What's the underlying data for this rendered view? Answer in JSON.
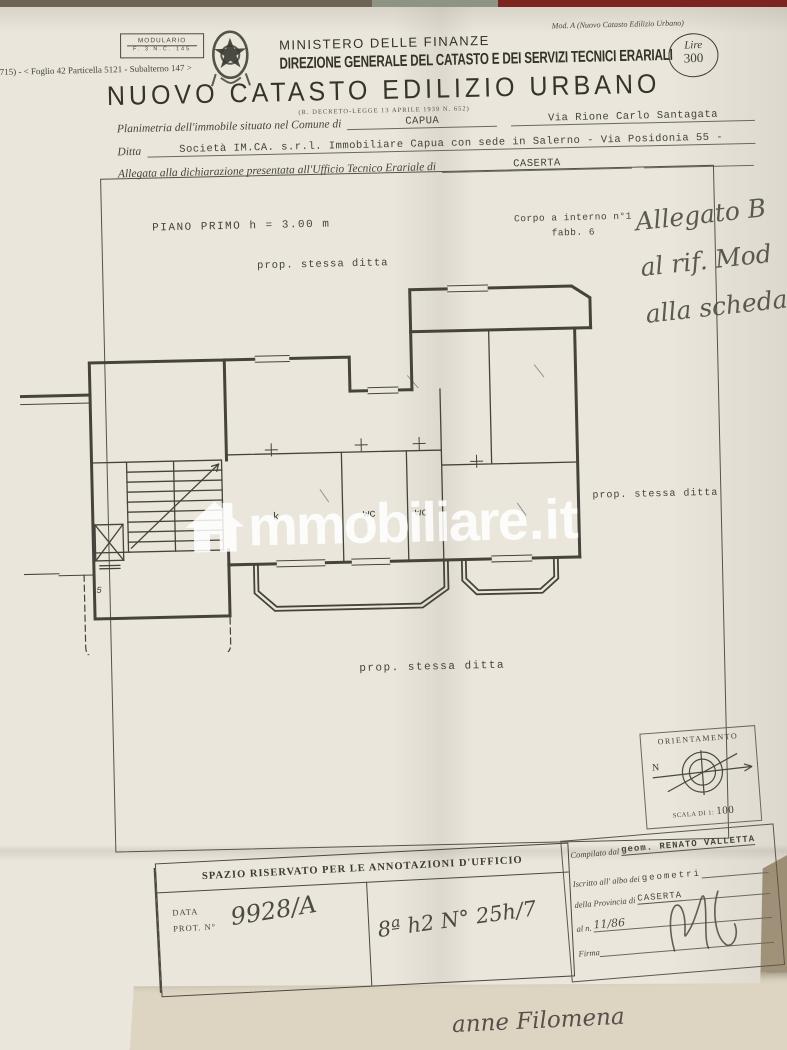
{
  "stamp": {
    "line1": "MODULARIO",
    "line2": "F. 3  N.C.  145"
  },
  "top_right_note": "Mod. A (Nuovo Catasto Edilizio Urbano)",
  "ref_line": "(B715) - < Foglio 42 Particella 5121 - Subalterno 147 >",
  "header": {
    "ministry": "MINISTERO DELLE FINANZE",
    "direction": "DIREZIONE GENERALE DEL CATASTO E DEI SERVIZI TECNICI ERARIALI",
    "title": "NUOVO CATASTO EDILIZIO URBANO",
    "subtitle": "(R. DECRETO-LEGGE 13 APRILE 1939 N. 652)",
    "lire_label": "Lire",
    "lire_value": "300"
  },
  "form": {
    "line1_label": "Planimetria dell'immobile situato nel Comune di",
    "line1_value": "CAPUA",
    "line1_value2": "Via Rione Carlo Santagata",
    "line2_label": "Ditta",
    "line2_value": "Società IM.CA. s.r.l. Immobiliare Capua con sede in Salerno - Via Posidonia 55 -",
    "line3_label": "Allegata alla dichiarazione presentata all'Ufficio Tecnico Erariale di",
    "line3_value": "CASERTA"
  },
  "plan": {
    "floor_label": "PIANO PRIMO h = 3.00 m",
    "corpo_label": "Corpo a interno n°1",
    "corpo_sub": "fabb. 6",
    "handwritten_note": [
      "Allegato B",
      "al rif. Mod",
      "alla scheda"
    ],
    "prop_top": "prop. stessa ditta",
    "prop_right": "prop. stessa ditta",
    "prop_bottom": "prop. stessa ditta",
    "rooms": {
      "kitchen": "k",
      "wc1": "wc",
      "wc2": "wc",
      "stair_mark": "5"
    },
    "orientation": {
      "title": "ORIENTAMENTO",
      "north": "N",
      "scale_label": "SCALA DI 1:",
      "scale_value": "100"
    }
  },
  "watermark": {
    "text": "mmobiliare",
    "suffix": ".it"
  },
  "office_box": {
    "title": "SPAZIO RISERVATO PER LE ANNOTAZIONI D'UFFICIO",
    "data_label": "DATA",
    "prot_label": "PROT. N°",
    "prot_value": "9928/A",
    "note_value": "8ª h2 N° 25h/7"
  },
  "surveyor_box": {
    "compiled_label": "Compilato dal",
    "compiled_value": "geom. RENATO VALLETTA",
    "enrolled_label": "Iscritto all' albo dei",
    "enrolled_value": "geometri",
    "province_label": "della Provincia di",
    "province_value": "CASERTA",
    "number_label": "al n.",
    "number_value": "11/86",
    "firma_label": "Firma"
  },
  "bottom_handwriting": "anne Filomena",
  "colors": {
    "paper": "#eae6dc",
    "paper_under": "#ddd5c2",
    "red_band": "#7b2420",
    "green_band": "#8d9483",
    "ink": "#45433a"
  }
}
